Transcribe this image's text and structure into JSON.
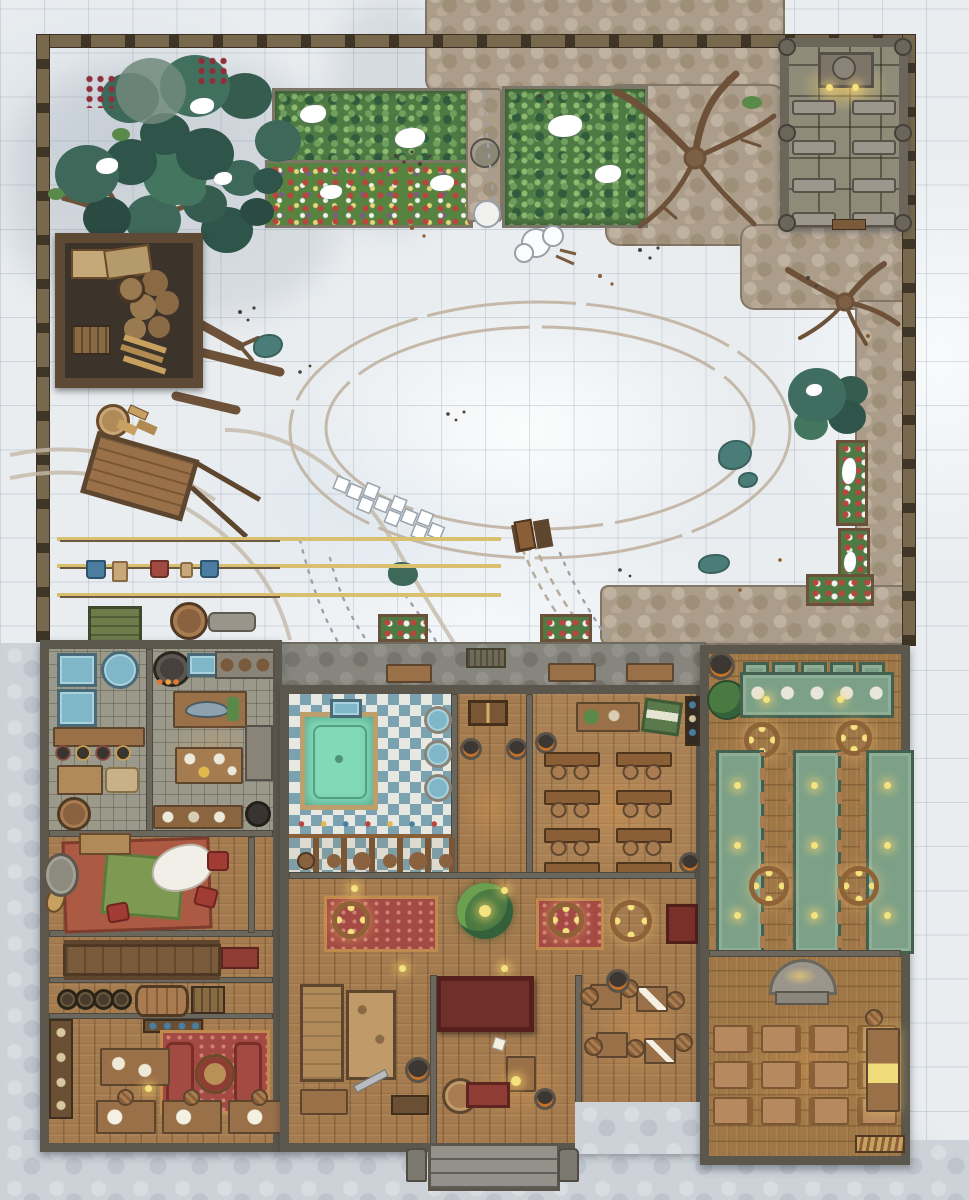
{
  "map": {
    "type": "top-down fantasy battlemap",
    "setting": "snow-covered walled lodge compound with courtyard, gardens and chapel",
    "grid_cell_px": 44,
    "palette": {
      "snow": "#e9edf0",
      "grid_line": "#8ca3b1",
      "cobblestone": "#ab9d8a",
      "exterior_pavers": "#ccd2d8",
      "wood_floor": "#a57c50",
      "stone_tile": "#9b998a",
      "pool_water": "#82d9b8",
      "bath_tile_blue": "#7ba2b0",
      "garden_green": "#4e7a44",
      "tree_canopy": "#3d685a",
      "dead_wood": "#6d5138",
      "felt_table_green": "#7ca188",
      "rug_red": "#a34a44",
      "stage_maroon": "#6f2f2a",
      "fence_wood": "#77684e",
      "candle_glow": "#f4e27e",
      "basin_blue": "#7fb6c8",
      "puddle_teal": "#4b7d78"
    },
    "outdoor": {
      "perimeter_fence": {
        "name": "wooden perimeter fence with square posts"
      },
      "tree_cluster_northwest": {
        "name": "snow-dusted evergreen and apple trees"
      },
      "dead_trees": {
        "name": "bare winter trees",
        "count": 4
      },
      "garden_west_plot": {
        "name": "fenced vegetable garden plot"
      },
      "garden_flower_strip": {
        "name": "flower border bed"
      },
      "garden_east_plot": {
        "name": "fenced vegetable garden plot"
      },
      "garden_statue": {
        "name": "stone statue on garden path"
      },
      "chapel": {
        "name": "stone chapel with altar and pews",
        "pews": 8,
        "altar_candles": 2
      },
      "lumber_shed": {
        "name": "wood store with stacked logs and planks"
      },
      "firewood_station": {
        "name": "chopping block and split firewood"
      },
      "hand_cart": {
        "name": "tipped wooden hand cart"
      },
      "clotheslines": {
        "name": "three clotheslines with hanging laundry",
        "lines": 3,
        "garments": 5
      },
      "courtyard": {
        "name": "snowy courtyard with oval sled track",
        "hopscotch": "scratched in snow",
        "sled": 1
      },
      "campfire_remains": {
        "name": "smouldering ash pile"
      },
      "puddles": {
        "name": "icy melt puddles",
        "count": 4
      },
      "side_path": {
        "name": "cobblestone path along east wall"
      },
      "east_planters": {
        "name": "stone planter beds with winter blooms"
      },
      "terrace": {
        "name": "stone terrace with benches and flower boxes",
        "benches": 3,
        "flower_boxes": 2
      },
      "storage_row": {
        "name": "green crate, barrel and grey bench"
      },
      "porch": {
        "name": "front steps flanked by horned statues",
        "statues": 2
      }
    },
    "building": {
      "name": "great lodge",
      "rooms": {
        "scullery": {
          "name": "scullery - wash tubs, counters and pot rack"
        },
        "kitchen": {
          "name": "kitchen - stove, fish prep table, dining table"
        },
        "bathhouse": {
          "name": "bath house - sunken pool, round basins, changing stalls"
        },
        "hall_corridor": {
          "name": "entry corridor with chest and braziers"
        },
        "classroom": {
          "name": "classroom - teacher desk, map board, eight double desks",
          "desks": 8
        },
        "lounge": {
          "name": "common lounge - red carpet, green rug, fur throw, cushions, lute"
        },
        "mess_corridor": {
          "name": "mess corridor with long bench table"
        },
        "cellar": {
          "name": "keg and barrel store",
          "kegs": 5
        },
        "study": {
          "name": "study - facing couches, round table, document table, writing desks",
          "writing_desks": 3
        },
        "great_hall": {
          "name": "great hall - indoor tree, patterned rugs, wheel chandeliers"
        },
        "stage": {
          "name": "raised maroon stage"
        },
        "workshop": {
          "name": "workshop - workbenches and tools"
        },
        "entry_hall": {
          "name": "reception hall - desk with lantern, red bench, cask table"
        },
        "game_room": {
          "name": "game room - four tables with striped stools",
          "tables": 4
        },
        "feast_hall": {
          "name": "feast hall - head table and three long green tables",
          "long_tables": 3,
          "chandeliers": 4
        },
        "dormitory": {
          "name": "dormitory - twelve sleeping mats, hearth and side table",
          "mats": 12
        }
      }
    }
  }
}
